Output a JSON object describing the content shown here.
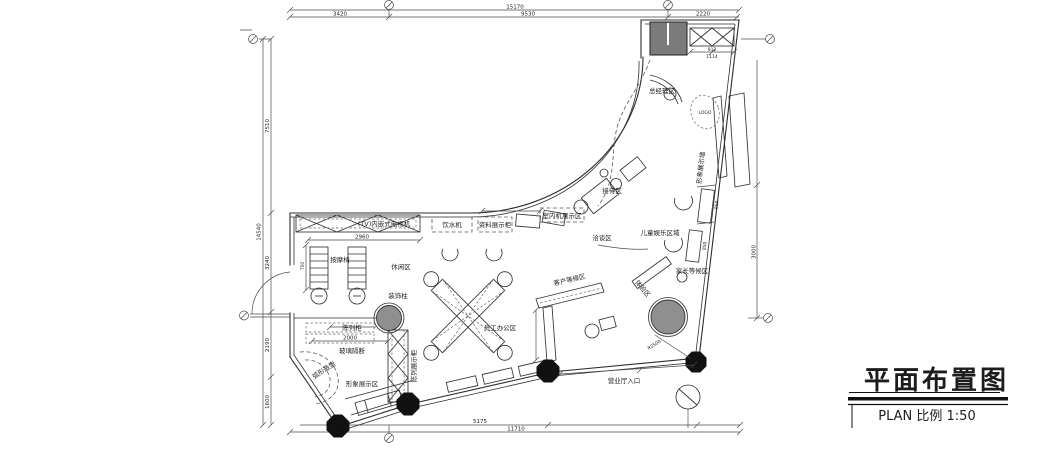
{
  "plan": {
    "title": "平面布置图",
    "scale_label": "PLAN 比例  1:50",
    "dims": {
      "top_total": "15170",
      "top_a": "3420",
      "top_b": "9530",
      "top_c": "2220",
      "left_total": "14540",
      "left_a": "7510",
      "left_b": "3240",
      "left_c": "2190",
      "left_d": "1600",
      "bottom_a": "5175",
      "bottom_total": "11710",
      "right_a": "3000",
      "tv_width": "2960",
      "partition": "2000",
      "cab_a": "912",
      "cab_b": "1114",
      "seat_a": "850",
      "seat_b": "850",
      "side_a": "700",
      "radius": "R2500"
    },
    "labels": {
      "tv": "(TV)内嵌式电视机",
      "massage": "按摩椅",
      "lounge": "休闲区",
      "pillar": "装饰柱",
      "display_cab": "陈列柜",
      "glass": "玻璃隔断",
      "arc_shape": "弧形造型",
      "image_area": "形象展示区",
      "hatch_cab": "陈列展示柜",
      "water": "饮水机",
      "files": "资料展示柜",
      "office": "员工办公区",
      "indoor_unit": "室内机展示区",
      "reception": "接待区",
      "talk": "洽谈区",
      "waiting": "客户等候区",
      "gm": "总经理区",
      "logo": "LOGO",
      "wall_disp": "形象展示墙",
      "kids": "儿童娱乐区域",
      "parents": "家长等候区",
      "experience": "体验区",
      "entrance": "营业厅入口"
    },
    "colors": {
      "line": "#2e2e2e",
      "column_fill": "#8f8f8f",
      "block_fill": "#7b7b7b"
    }
  }
}
